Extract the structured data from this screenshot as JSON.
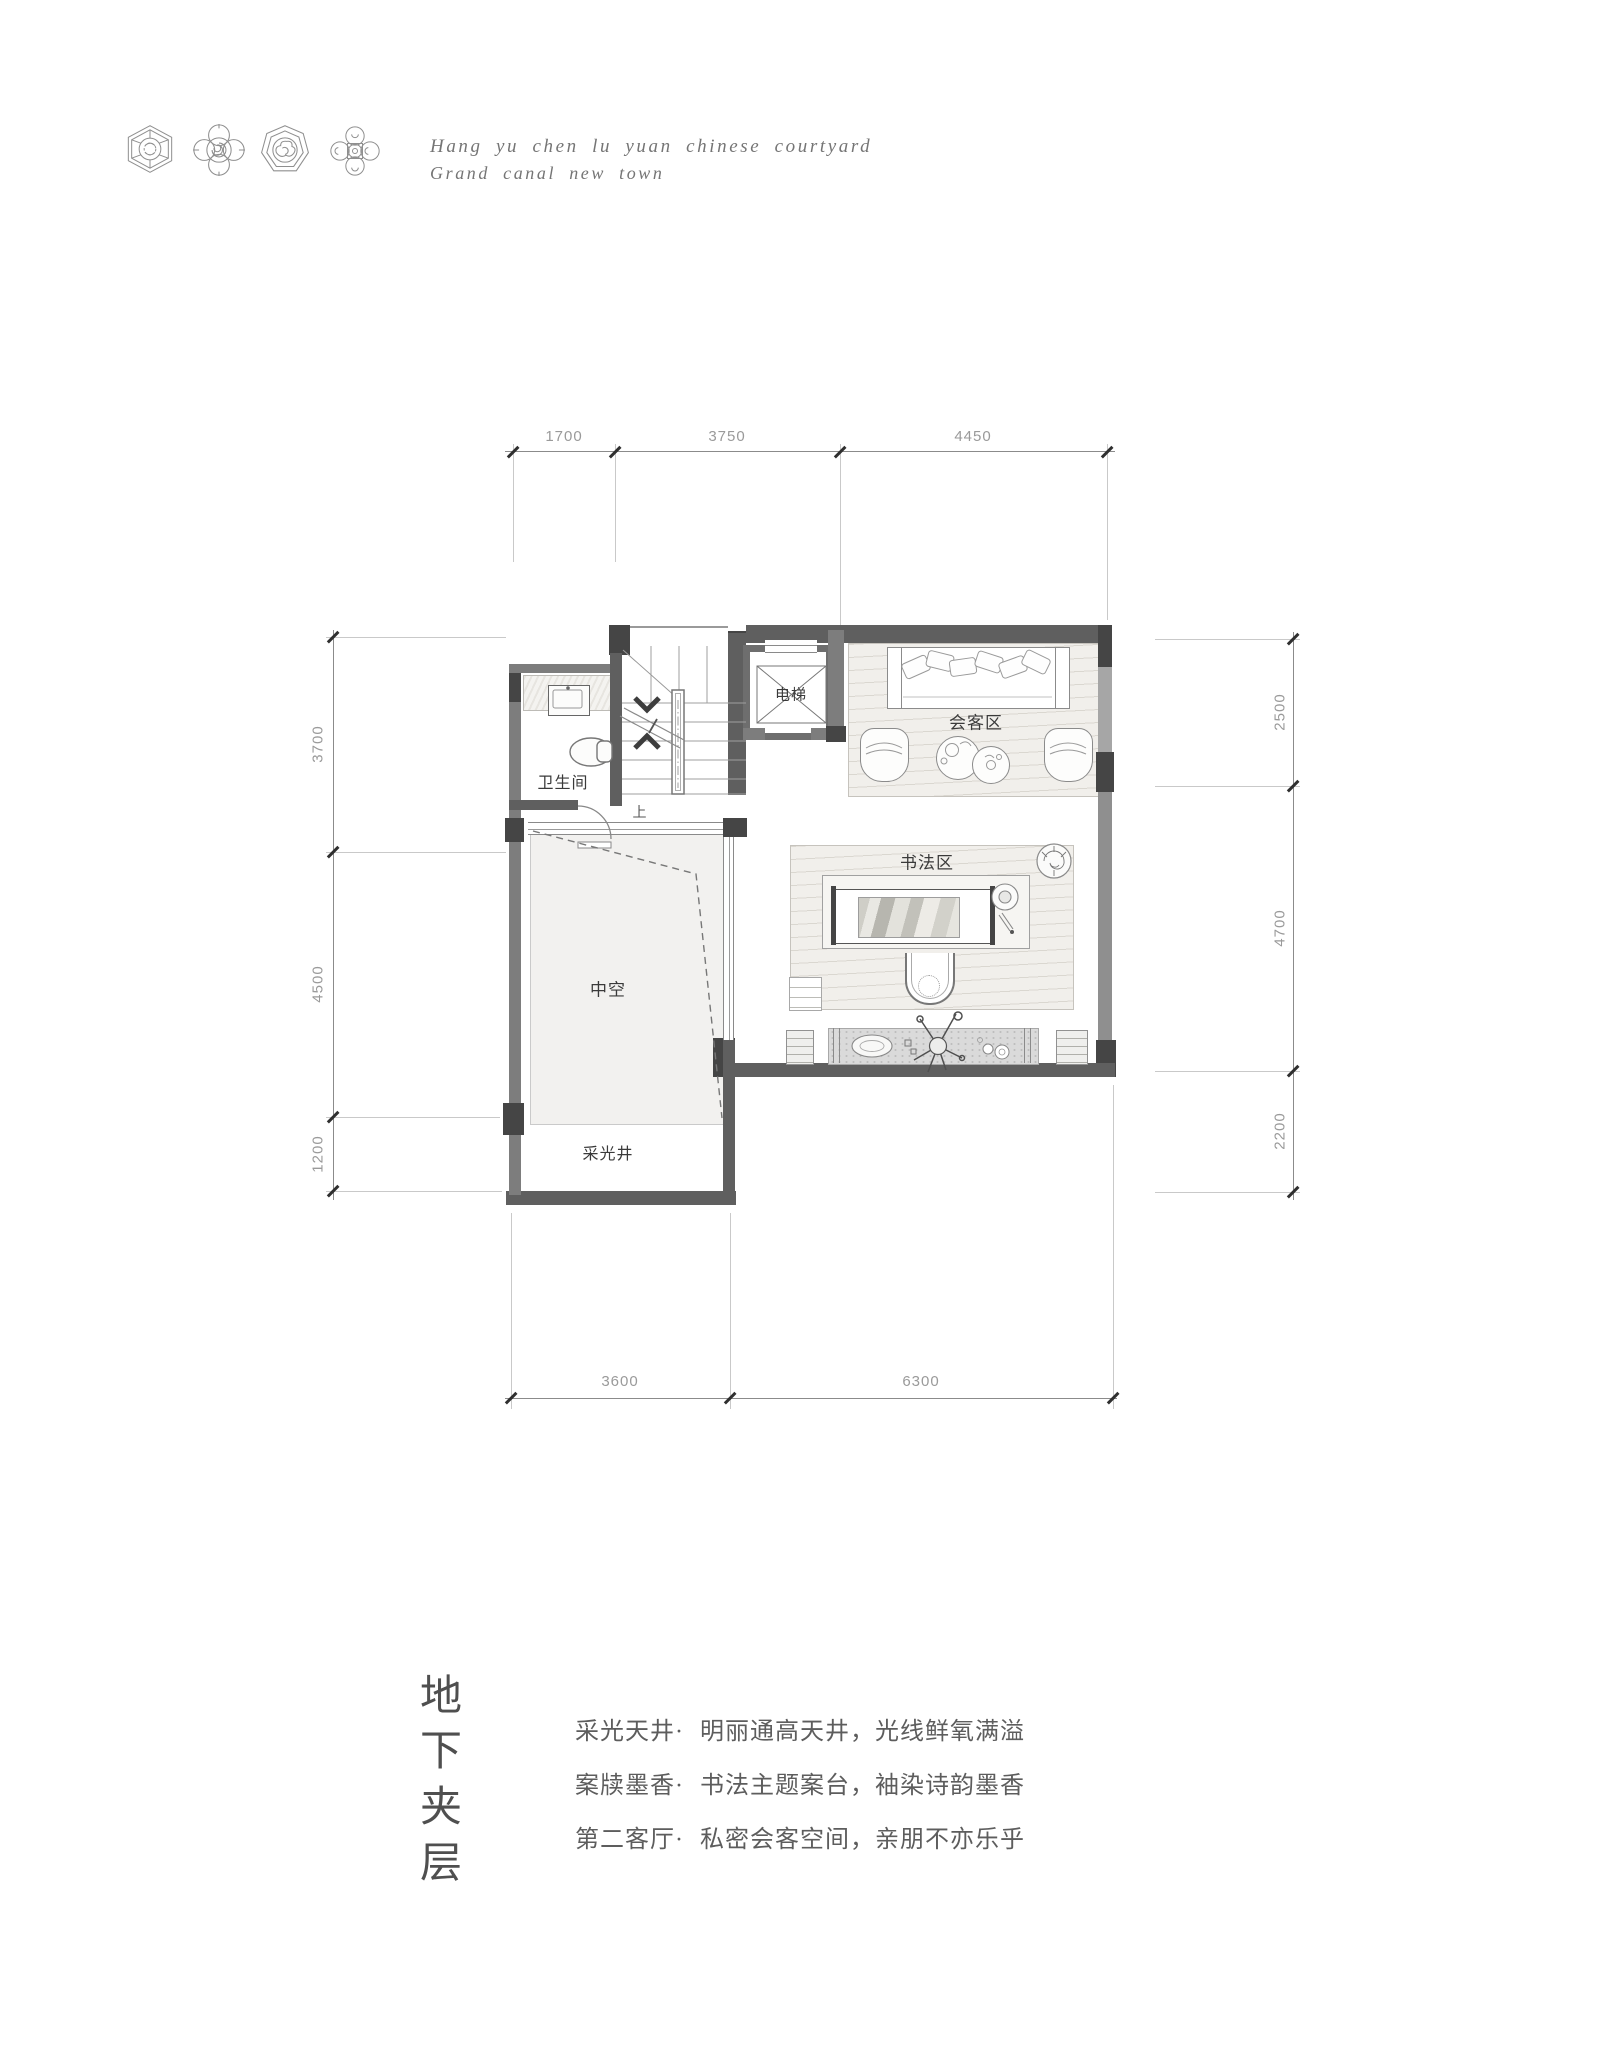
{
  "header": {
    "line1": "Hang yu chen lu yuan chinese courtyard",
    "line2": "Grand canal new town",
    "ornament_icons": [
      "hexagon-medallion-icon",
      "quatrefoil-spiral-medallion-icon",
      "heptagon-cloud-medallion-icon",
      "quatrefoil-rings-medallion-icon"
    ]
  },
  "plan": {
    "rooms": {
      "elevator": "电梯",
      "meeting_area": "会客区",
      "bathroom": "卫生间",
      "calligraphy_area": "书法区",
      "void": "中空",
      "light_well": "采光井",
      "stairs_up": "上"
    },
    "dimensions": {
      "top": [
        "1700",
        "3750",
        "4450"
      ],
      "left": [
        "3700",
        "4500",
        "1200"
      ],
      "right": [
        "2500",
        "4700",
        "2200"
      ],
      "bottom": [
        "3600",
        "6300"
      ]
    }
  },
  "footer": {
    "title": "地下夹层",
    "title_chars": [
      "地",
      "下",
      "夹",
      "层"
    ],
    "features": [
      {
        "label": "采光天井·",
        "text": "明丽通高天井，光线鲜氧满溢"
      },
      {
        "label": "案牍墨香·",
        "text": "书法主题案台，袖染诗韵墨香"
      },
      {
        "label": "第二客厅·",
        "text": "私密会客空间，亲朋不亦乐乎"
      }
    ]
  },
  "colors": {
    "wall": "#5f5f5f",
    "pillar": "#454545",
    "wall_mid": "#7d7d7d",
    "wall_light": "#8f8f8f",
    "window": "#a6a6a6",
    "line": "#8b8b8b",
    "dim_text": "#9a9a9a",
    "room_label": "#3a3a3a",
    "body_text": "#5d5d5d",
    "wood": "#f1efeb",
    "void_fill": "#f2f1ef",
    "console": "#dadada"
  }
}
